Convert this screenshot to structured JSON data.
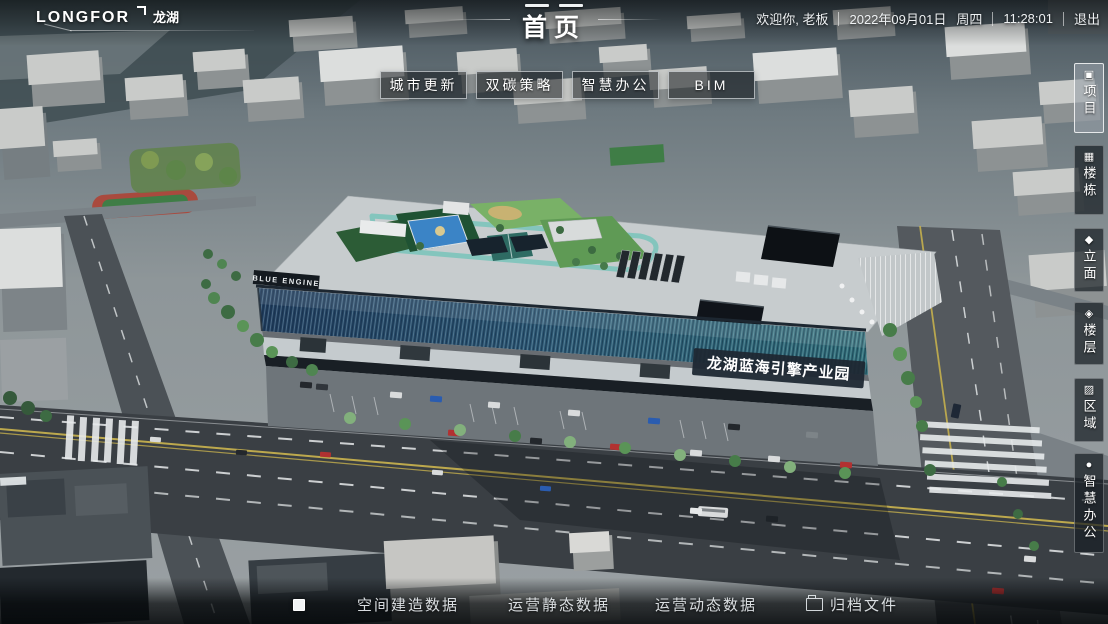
{
  "header": {
    "logo_text": "LONGFOR",
    "logo_cn": "龙湖",
    "title": "首页",
    "welcome": "欢迎你, 老板",
    "date": "2022年09月01日",
    "weekday": "周四",
    "time": "11:28:01",
    "logout_label": "退出"
  },
  "quick_nav": {
    "buttons": [
      {
        "label": "城市更新"
      },
      {
        "label": "双碳策略"
      },
      {
        "label": "智慧办公"
      },
      {
        "label": "BIM"
      }
    ]
  },
  "sidebar": {
    "items": [
      {
        "label": "项目",
        "icon": "project-icon",
        "glyph": "▣",
        "active": true
      },
      {
        "label": "楼栋",
        "icon": "building-icon",
        "glyph": "▦",
        "active": false
      },
      {
        "label": "立面",
        "icon": "facade-icon",
        "glyph": "◆",
        "active": false
      },
      {
        "label": "楼层",
        "icon": "floors-icon",
        "glyph": "◈",
        "active": false
      },
      {
        "label": "区域",
        "icon": "area-icon",
        "glyph": "▨",
        "active": false
      },
      {
        "label": "智慧办公",
        "icon": "smart-office-icon",
        "glyph": "●",
        "active": false
      }
    ]
  },
  "bottom_nav": {
    "marker_icon": "square-marker-icon",
    "items": [
      {
        "label": "空间建造数据",
        "icon": ""
      },
      {
        "label": "运营静态数据",
        "icon": ""
      },
      {
        "label": "运营动态数据",
        "icon": ""
      },
      {
        "label": "归档文件",
        "icon": "folder-icon"
      }
    ]
  },
  "scene": {
    "building_banner": "龙湖蓝海引擎产业园",
    "building_sign": "BLUE ENGINE"
  },
  "colors": {
    "facade_glass_left": "#1f3a5c",
    "facade_glass_right": "#2f6e78",
    "roof": "#c7ccce",
    "garden_green": "#76b068",
    "pool_blue": "#3c86c8",
    "road": "#3a3f44",
    "lane_yellow": "#c4af4e",
    "ui_border": "rgba(255,255,255,0.65)"
  }
}
